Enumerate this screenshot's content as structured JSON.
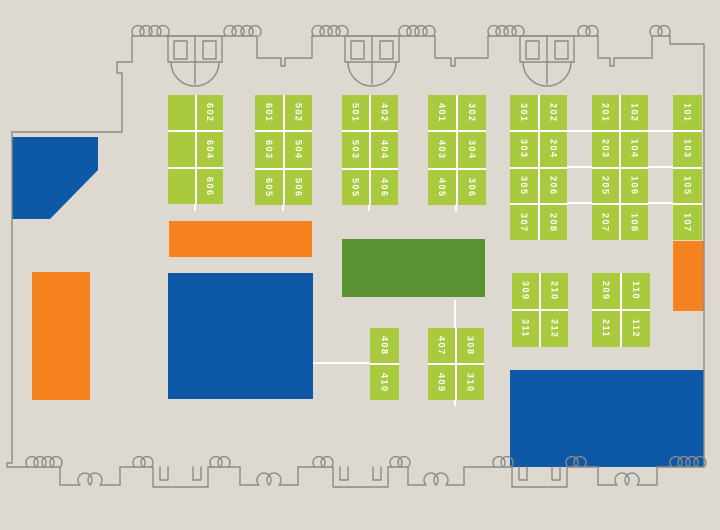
{
  "title": "exhibit-hall-floor-plan",
  "colors": {
    "background": "#ddd9d1",
    "booth_green": "#a9c93e",
    "feature_green": "#589231",
    "feature_blue": "#0e58a8",
    "feature_orange": "#f6821f",
    "wall_gray": "#8b8b85",
    "divider_white": "#ffffff",
    "booth_text": "#ffffff"
  },
  "icons": {
    "entrance_doors": "double-door-plan-symbol",
    "door_swing": "door-swing-arc-symbol"
  },
  "booth_blocks": [
    {
      "id": "block-600",
      "x": 168,
      "y": 95,
      "w": 55,
      "h": 109,
      "rows": 3,
      "cols": 2,
      "labels": [
        [
          "",
          "602"
        ],
        [
          "",
          "604"
        ],
        [
          "",
          "606"
        ]
      ]
    },
    {
      "id": "block-500-600",
      "x": 255,
      "y": 95,
      "w": 57,
      "h": 110,
      "rows": 3,
      "cols": 2,
      "labels": [
        [
          "601",
          "502"
        ],
        [
          "603",
          "504"
        ],
        [
          "605",
          "506"
        ]
      ]
    },
    {
      "id": "block-400-500",
      "x": 342,
      "y": 95,
      "w": 56,
      "h": 110,
      "rows": 3,
      "cols": 2,
      "labels": [
        [
          "501",
          "402"
        ],
        [
          "503",
          "404"
        ],
        [
          "505",
          "406"
        ]
      ]
    },
    {
      "id": "block-300-400",
      "x": 428,
      "y": 95,
      "w": 58,
      "h": 110,
      "rows": 3,
      "cols": 2,
      "labels": [
        [
          "401",
          "302"
        ],
        [
          "403",
          "304"
        ],
        [
          "405",
          "306"
        ]
      ]
    },
    {
      "id": "block-200-300",
      "x": 510,
      "y": 95,
      "w": 57,
      "h": 145,
      "rows": 4,
      "cols": 2,
      "labels": [
        [
          "301",
          "202"
        ],
        [
          "303",
          "204"
        ],
        [
          "305",
          "206"
        ],
        [
          "307",
          "208"
        ]
      ]
    },
    {
      "id": "block-100-200",
      "x": 592,
      "y": 95,
      "w": 56,
      "h": 145,
      "rows": 4,
      "cols": 2,
      "labels": [
        [
          "201",
          "102"
        ],
        [
          "203",
          "104"
        ],
        [
          "205",
          "106"
        ],
        [
          "207",
          "108"
        ]
      ]
    },
    {
      "id": "block-100",
      "x": 673,
      "y": 95,
      "w": 29,
      "h": 145,
      "rows": 4,
      "cols": 1,
      "labels": [
        [
          "101"
        ],
        [
          "103"
        ],
        [
          "105"
        ],
        [
          "107"
        ]
      ]
    },
    {
      "id": "block-300-200-mid",
      "x": 512,
      "y": 273,
      "w": 56,
      "h": 74,
      "rows": 2,
      "cols": 2,
      "labels": [
        [
          "309",
          "210"
        ],
        [
          "311",
          "212"
        ]
      ]
    },
    {
      "id": "block-200-100-mid",
      "x": 592,
      "y": 273,
      "w": 58,
      "h": 74,
      "rows": 2,
      "cols": 2,
      "labels": [
        [
          "209",
          "110"
        ],
        [
          "211",
          "112"
        ]
      ]
    },
    {
      "id": "block-408",
      "x": 370,
      "y": 328,
      "w": 29,
      "h": 72,
      "rows": 2,
      "cols": 1,
      "labels": [
        [
          "408"
        ],
        [
          "410"
        ]
      ]
    },
    {
      "id": "block-407-308",
      "x": 428,
      "y": 328,
      "w": 56,
      "h": 72,
      "rows": 2,
      "cols": 2,
      "labels": [
        [
          "407",
          "308"
        ],
        [
          "409",
          "310"
        ]
      ]
    }
  ],
  "features": [
    {
      "name": "feature-blue-wedge",
      "shape": "polygon",
      "x": 12,
      "y": 137,
      "w": 86,
      "h": 82,
      "points": "0,0 86,0 86,33 38,82 0,82",
      "color_key": "feature_blue"
    },
    {
      "name": "feature-orange-bar",
      "shape": "rect",
      "x": 169,
      "y": 221,
      "w": 143,
      "h": 36,
      "color_key": "feature_orange"
    },
    {
      "name": "feature-blue-left",
      "shape": "rect",
      "x": 168,
      "y": 273,
      "w": 145,
      "h": 126,
      "color_key": "feature_blue"
    },
    {
      "name": "feature-orange-left",
      "shape": "rect",
      "x": 32,
      "y": 272,
      "w": 58,
      "h": 128,
      "color_key": "feature_orange"
    },
    {
      "name": "feature-green-center",
      "shape": "rect",
      "x": 342,
      "y": 239,
      "w": 143,
      "h": 58,
      "color_key": "feature_green"
    },
    {
      "name": "feature-blue-right",
      "shape": "rect",
      "x": 510,
      "y": 370,
      "w": 194,
      "h": 97,
      "color_key": "feature_blue"
    },
    {
      "name": "feature-orange-right",
      "shape": "rect",
      "x": 673,
      "y": 241,
      "w": 31,
      "h": 70,
      "color_key": "feature_orange"
    }
  ],
  "aisle_lines": [
    {
      "x": 567,
      "y": 130,
      "w": 25,
      "h": 2
    },
    {
      "x": 648,
      "y": 130,
      "w": 25,
      "h": 2
    },
    {
      "x": 567,
      "y": 166,
      "w": 25,
      "h": 2
    },
    {
      "x": 648,
      "y": 166,
      "w": 25,
      "h": 2
    },
    {
      "x": 567,
      "y": 202,
      "w": 25,
      "h": 2
    },
    {
      "x": 648,
      "y": 202,
      "w": 25,
      "h": 2
    },
    {
      "x": 313,
      "y": 362,
      "w": 57,
      "h": 2
    },
    {
      "x": 454,
      "y": 300,
      "w": 2,
      "h": 28
    },
    {
      "x": 454,
      "y": 400,
      "w": 2,
      "h": 6
    },
    {
      "x": 194,
      "y": 204,
      "w": 2,
      "h": 7
    },
    {
      "x": 282,
      "y": 204,
      "w": 2,
      "h": 7
    },
    {
      "x": 368,
      "y": 204,
      "w": 2,
      "h": 7
    },
    {
      "x": 455,
      "y": 204,
      "w": 2,
      "h": 7
    }
  ]
}
